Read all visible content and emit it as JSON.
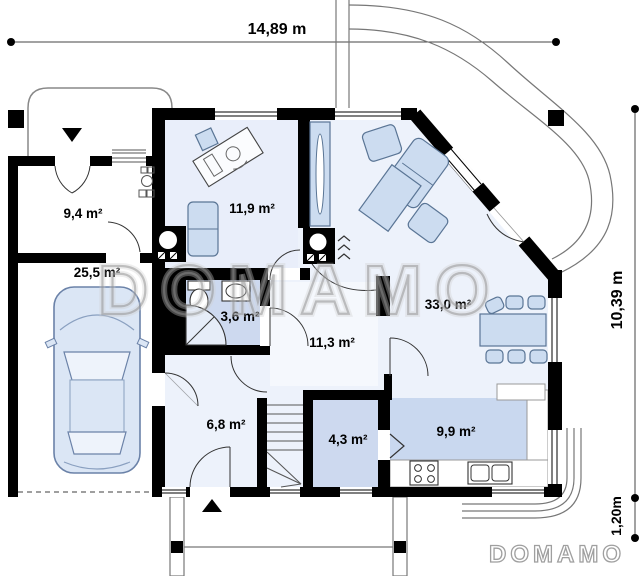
{
  "plan": {
    "type": "single-storey house floor plan"
  },
  "dimensions": {
    "width_top": "14,89 m",
    "height_right": "10,39 m",
    "steps_right": "1,20m"
  },
  "rooms": [
    {
      "name": "utility-room",
      "area": "9,4 m²"
    },
    {
      "name": "garage",
      "area": "25,5 m²"
    },
    {
      "name": "office",
      "area": "11,9 m²"
    },
    {
      "name": "bathroom",
      "area": "3,6 m²"
    },
    {
      "name": "hall",
      "area": "11,3 m²"
    },
    {
      "name": "living-dining-room",
      "area": "33,0 m²"
    },
    {
      "name": "vestibule",
      "area": "6,8 m²"
    },
    {
      "name": "pantry",
      "area": "4,3 m²"
    },
    {
      "name": "kitchen",
      "area": "9,9 m²"
    }
  ],
  "watermark": {
    "center": "DOMAMO",
    "corner": "DOMAMO"
  },
  "markers": {
    "main_entrance": "triangle-down",
    "front_entrance": "triangle-up"
  },
  "colors": {
    "wall": "#000000",
    "floor_light": "#edf2fb",
    "floor_medium": "#cdd9ef",
    "kitchen_floor": "#c9d8ef",
    "furniture": "#ccdcf0",
    "watermark": "#9a9a9a"
  }
}
